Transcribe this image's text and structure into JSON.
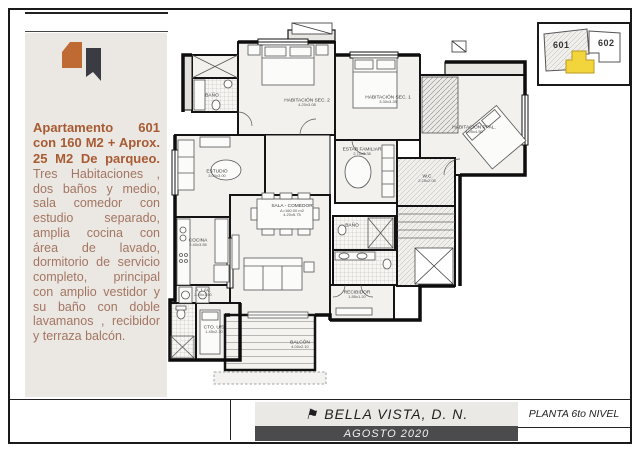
{
  "left_panel": {
    "headline": "Apartamento 601 con 160 M2 + Aprox. 25 M2 De parqueo.",
    "body": "Tres Habitaciones , dos baños y medio, sala comedor con estudio separado, amplia cocina con área de lavado, dormitorio de servicio completo, principal con amplio vestidor y su baño con doble lavamanos , recibidor y terraza balcón."
  },
  "key_plan": {
    "unit_left": "601",
    "unit_right": "602"
  },
  "plan": {
    "rooms": [
      {
        "name": "BAÑO",
        "dims": ""
      },
      {
        "name": "HABITACIÓN SEC. 2",
        "dims": "4.20x3.08"
      },
      {
        "name": "HABITACIÓN SEC. 1",
        "dims": "3.30x3.28"
      },
      {
        "name": "HABITACIÓN PPAL.",
        "dims": "4.05x4.50"
      },
      {
        "name": "ESTAR FAMILIAR",
        "dims": "2.70x3.38"
      },
      {
        "name": "W.C",
        "dims": "2.25x2.05"
      },
      {
        "name": "ESTUDIO",
        "dims": "3.00x3.00"
      },
      {
        "name": "SALA - COMEDOR",
        "area": "A=160.00 m2",
        "dims": "4.20x5.75"
      },
      {
        "name": "COCINA",
        "dims": "2.40x3.55"
      },
      {
        "name": "A. LAV.",
        "dims": "2.40x1.50"
      },
      {
        "name": "CTO. U/S",
        "dims": "1.45x2.30"
      },
      {
        "name": "BAÑO",
        "dims": ""
      },
      {
        "name": "RECIBIDOR",
        "dims": "1.85x1.20"
      },
      {
        "name": "BALCÓN",
        "dims": "4.00x2.10"
      }
    ]
  },
  "footer": {
    "flag_icon": "⚑",
    "project": "BELLA VISTA, D. N.",
    "date": "AGOSTO 2020",
    "sheet": "PLANTA 6to NIVEL"
  },
  "colors": {
    "headline_brown": "#a85a32",
    "body_brown": "#a37561",
    "logo_orange": "#bf6a33",
    "logo_dark": "#3b3b43",
    "keyplan_highlight": "#f2d53c",
    "footer_bar": "#4b4b4d"
  }
}
